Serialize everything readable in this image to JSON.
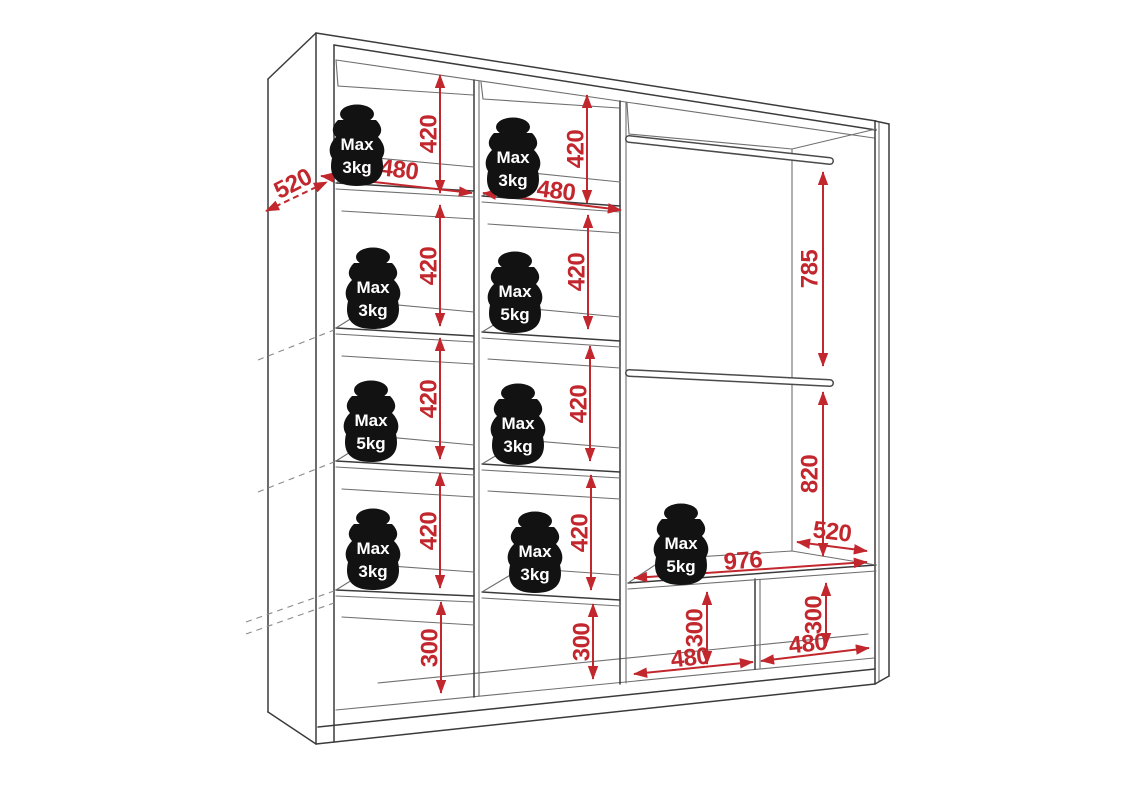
{
  "diagram": {
    "title": "wardrobe-interior-dimensions",
    "colors": {
      "dimension": "#C1272D",
      "outline": "#3b3b3b",
      "weight_fill": "#121212",
      "weight_text": "#ffffff"
    },
    "dims": [
      {
        "id": "col1-row1-height",
        "value": "420"
      },
      {
        "id": "col1-row2-height",
        "value": "420"
      },
      {
        "id": "col1-row3-height",
        "value": "420"
      },
      {
        "id": "col1-row4-height",
        "value": "420"
      },
      {
        "id": "col1-bottom-height",
        "value": "300"
      },
      {
        "id": "col2-row1-height",
        "value": "420"
      },
      {
        "id": "col2-row2-height",
        "value": "420"
      },
      {
        "id": "col2-row3-height",
        "value": "420"
      },
      {
        "id": "col2-row4-height",
        "value": "420"
      },
      {
        "id": "col2-bottom-height",
        "value": "300"
      },
      {
        "id": "rail-top-to-middle",
        "value": "785"
      },
      {
        "id": "rail-middle-to-bench",
        "value": "820"
      },
      {
        "id": "bench-left-cubby-height",
        "value": "300"
      },
      {
        "id": "bench-right-cubby-height",
        "value": "300"
      },
      {
        "id": "col1-width",
        "value": "480"
      },
      {
        "id": "col2-width",
        "value": "480"
      },
      {
        "id": "bench-width",
        "value": "976"
      },
      {
        "id": "bench-left-cubby-width",
        "value": "480"
      },
      {
        "id": "bench-right-cubby-width",
        "value": "480"
      },
      {
        "id": "bench-depth",
        "value": "520"
      },
      {
        "id": "wardrobe-depth",
        "value": "520"
      }
    ],
    "weights": [
      {
        "id": "col1-row1",
        "line1": "Max",
        "line2": "3kg"
      },
      {
        "id": "col1-row2",
        "line1": "Max",
        "line2": "3kg"
      },
      {
        "id": "col1-row3",
        "line1": "Max",
        "line2": "5kg"
      },
      {
        "id": "col1-row4",
        "line1": "Max",
        "line2": "3kg"
      },
      {
        "id": "col2-row1",
        "line1": "Max",
        "line2": "3kg"
      },
      {
        "id": "col2-row2",
        "line1": "Max",
        "line2": "5kg"
      },
      {
        "id": "col2-row3",
        "line1": "Max",
        "line2": "3kg"
      },
      {
        "id": "col2-row4",
        "line1": "Max",
        "line2": "3kg"
      },
      {
        "id": "bench",
        "line1": "Max",
        "line2": "5kg"
      }
    ]
  }
}
